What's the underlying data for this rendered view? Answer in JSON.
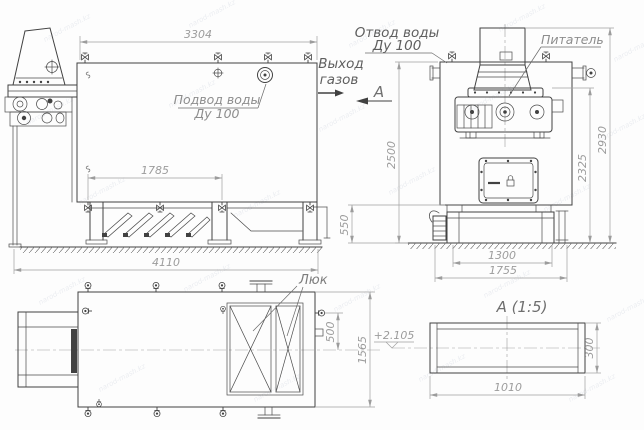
{
  "watermark": {
    "text": "narod-mash.kz"
  },
  "side_view": {
    "dim_top": "3304",
    "dim_drain": "1785",
    "dim_bottom": "4110",
    "water_inlet_line1": "Подвод воды",
    "water_inlet_line2": "Ду 100"
  },
  "front_view": {
    "water_outlet_line1": "Отвод воды",
    "water_outlet_line2": "Ду 100",
    "gas_outlet_line1": "Выход",
    "gas_outlet_line2": "газов",
    "section_letter": "А",
    "feeder_label": "Питатель",
    "dim_height_body": "2500",
    "dim_base_height": "550",
    "dim_feeder_height": "2325",
    "dim_total_height": "2930",
    "dim_base_width": "1300",
    "dim_base_full": "1755"
  },
  "top_view": {
    "hatch_label": "Люк",
    "dim_nozzle_offset": "500",
    "dim_depth": "1565",
    "elevation_mark": "+2.105"
  },
  "section_view": {
    "title": "А  (1:5)",
    "dim_length": "1010",
    "dim_height": "300"
  }
}
